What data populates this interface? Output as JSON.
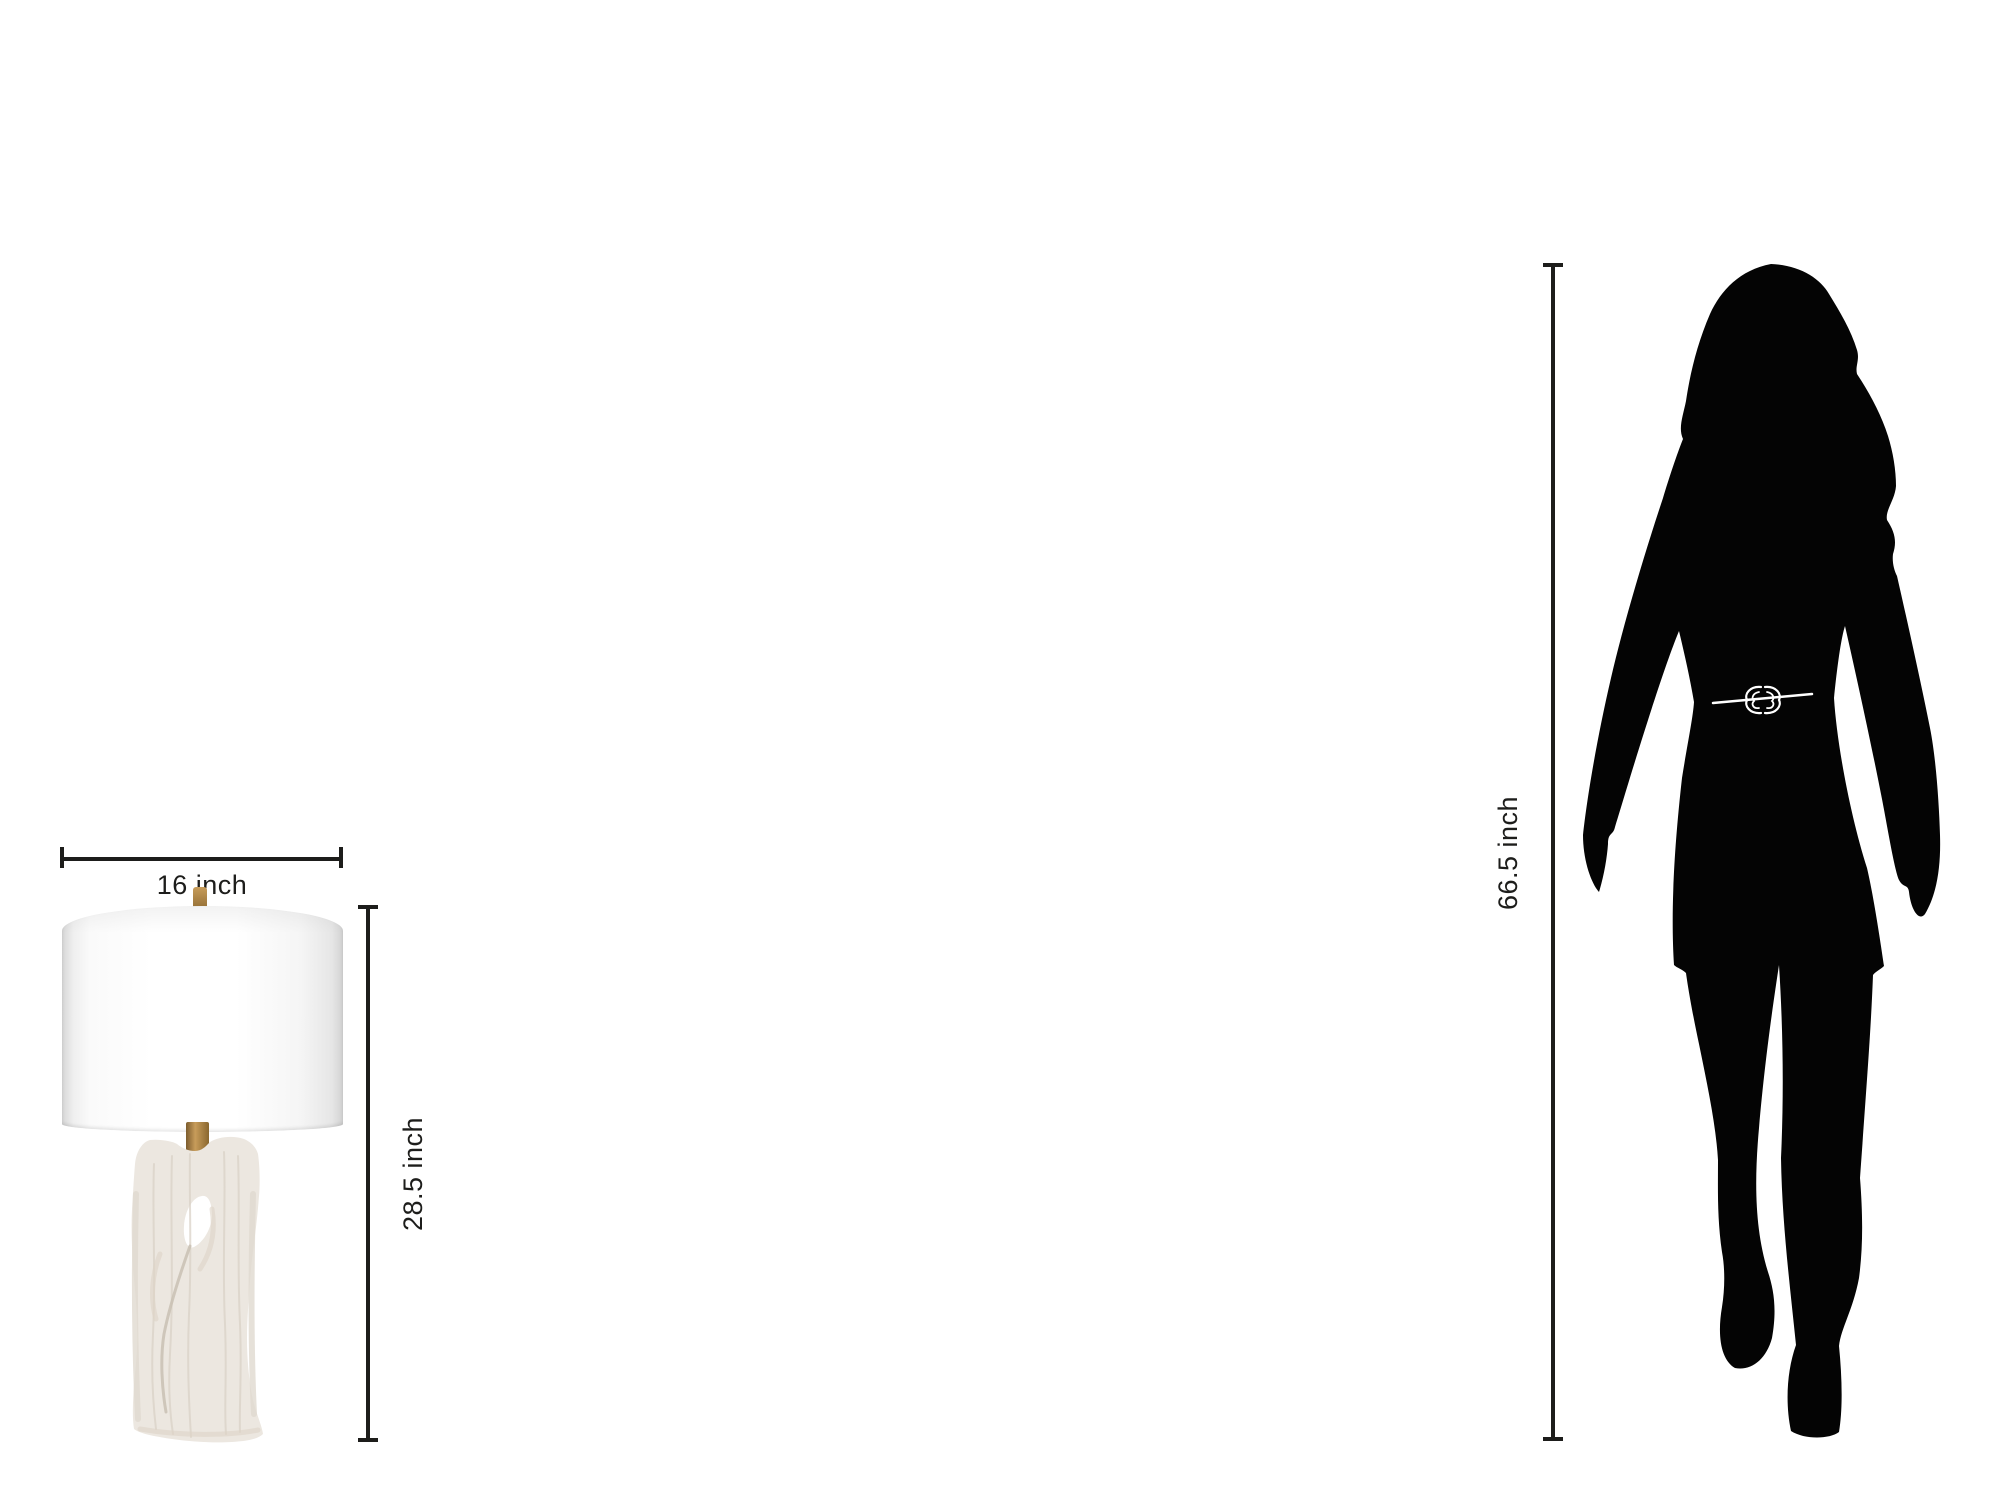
{
  "page": {
    "type": "product-dimension-diagram",
    "background": "#ffffff"
  },
  "product": {
    "name": "sculptural ceramic table lamp with white drum shade",
    "width_label": "16 inch",
    "height_label": "28.5 inch"
  },
  "reference_figure": {
    "name": "standing woman silhouette (rear view)",
    "height_label": "66.5 inch"
  },
  "colors": {
    "bg": "#ffffff",
    "ink": "#1d1d1b",
    "silhouette": "#040404",
    "ceramic": "#ece7e0",
    "brass-light": "#c79c5a",
    "brass-dark": "#8a672e"
  }
}
